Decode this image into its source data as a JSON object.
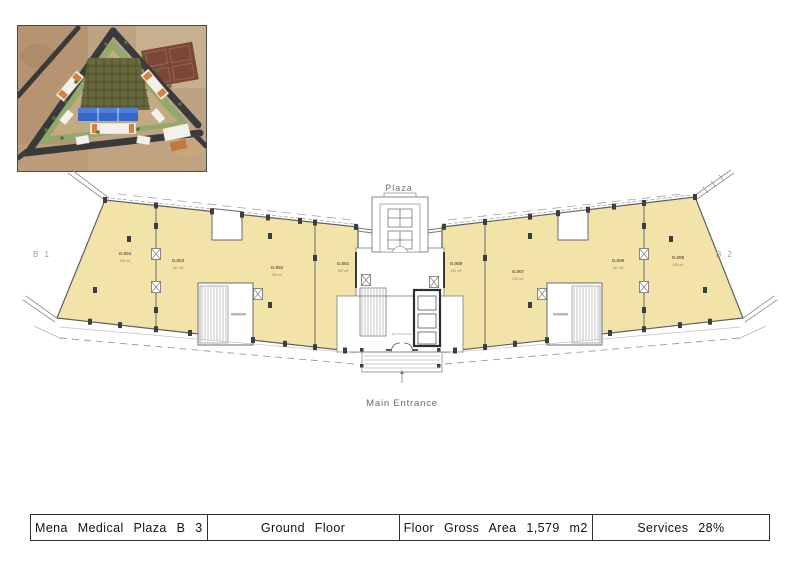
{
  "sheet": {
    "title_block": {
      "project": "Mena Medical Plaza B 3",
      "floor": "Ground Floor",
      "gross_area": "Floor Gross Area 1,579 m2",
      "services": "Services 28%"
    }
  },
  "plan": {
    "labels": {
      "plaza": "Plaza",
      "main_entrance": "Main Entrance",
      "entrance": "ENTRANCE",
      "b1": "B 1",
      "b2": "B 2"
    },
    "units": [
      {
        "id": "G.004",
        "area": "208 m2"
      },
      {
        "id": "G.003",
        "area": "161 m2"
      },
      {
        "id": "G.002",
        "area": "230 m2"
      },
      {
        "id": "G.001",
        "area": "140 m2"
      },
      {
        "id": "G.008",
        "area": "140 m2"
      },
      {
        "id": "G.007",
        "area": "230 m2"
      },
      {
        "id": "G.006",
        "area": "161 m2"
      },
      {
        "id": "G.005",
        "area": "208 m2"
      }
    ],
    "colors": {
      "unit_fill": "#f2e3a9",
      "wall": "#5f6062",
      "column": "#3d3e40",
      "pool_blue": "#3566c8",
      "road_dark": "#3a3a3c",
      "site_ground": "#bda283"
    }
  }
}
